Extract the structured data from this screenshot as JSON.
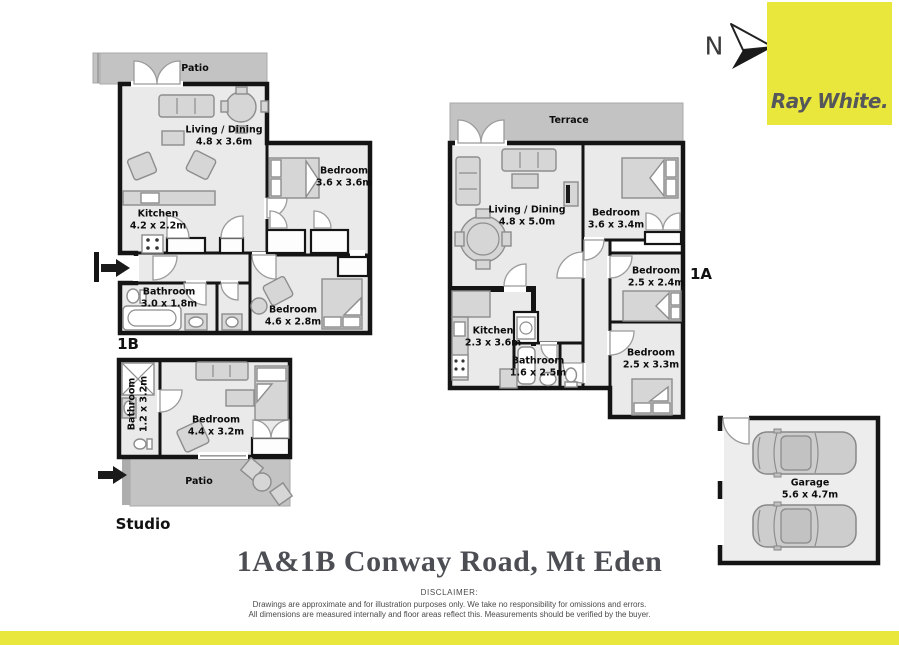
{
  "brand": {
    "logo_text": "Ray White.",
    "north_label": "N"
  },
  "title": "1A&1B Conway Road, Mt Eden",
  "disclaimer": {
    "heading": "DISCLAIMER:",
    "line1": "Drawings are approximate and for illustration purposes only. We take no responsibility for omissions and errors.",
    "line2": "All dimensions are measured internally and floor areas reflect this. Measurements should be verified by the buyer."
  },
  "units": {
    "unit_1b": {
      "label": "1B",
      "rooms": {
        "patio": {
          "name": "Patio"
        },
        "living": {
          "name": "Living / Dining",
          "dims": "4.8 x 3.6m"
        },
        "bedroom1": {
          "name": "Bedroom",
          "dims": "3.6 x 3.6m"
        },
        "kitchen": {
          "name": "Kitchen",
          "dims": "4.2 x 2.2m"
        },
        "bathroom": {
          "name": "Bathroom",
          "dims": "3.0 x 1.8m"
        },
        "bedroom2": {
          "name": "Bedroom",
          "dims": "4.6 x 2.8m"
        }
      }
    },
    "unit_1a": {
      "label": "1A",
      "rooms": {
        "terrace": {
          "name": "Terrace"
        },
        "living": {
          "name": "Living / Dining",
          "dims": "4.8 x 5.0m"
        },
        "bedroom1": {
          "name": "Bedroom",
          "dims": "3.6 x 3.4m"
        },
        "bedroom2": {
          "name": "Bedroom",
          "dims": "2.5 x 2.4m"
        },
        "kitchen": {
          "name": "Kitchen",
          "dims": "2.3 x 3.6m"
        },
        "bathroom": {
          "name": "Bathroom",
          "dims": "1.6 x 2.5m"
        },
        "bedroom3": {
          "name": "Bedroom",
          "dims": "2.5 x 3.3m"
        }
      }
    },
    "studio": {
      "label": "Studio",
      "rooms": {
        "bathroom": {
          "name": "Bathroom",
          "dims": "1.2 x 3.2m"
        },
        "bedroom": {
          "name": "Bedroom",
          "dims": "4.4 x 3.2m"
        },
        "patio": {
          "name": "Patio"
        }
      }
    },
    "garage": {
      "rooms": {
        "garage": {
          "name": "Garage",
          "dims": "5.6 x 4.7m"
        }
      }
    }
  },
  "colors": {
    "brand_yellow": "#E9E63C",
    "wall": "#141414",
    "floor": "#EAEAEA",
    "outdoor": "#C3C3C3",
    "furniture": "#D6D6D6",
    "title_text": "#4D4E54"
  }
}
